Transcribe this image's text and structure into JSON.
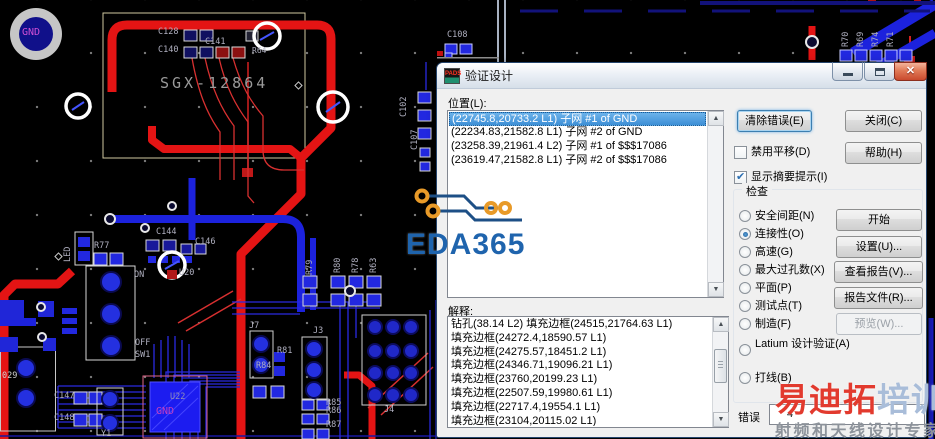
{
  "dialog": {
    "icon_text": "PADS",
    "title": "验证设计",
    "location_label": "位置(L):",
    "location_items": [
      "(22745.8,20733.2 L1) 子网 #1 of GND",
      "(22234.83,21582.8 L1) 子网 #2 of GND",
      "(23258.39,21961.4 L2) 子网 #1 of $$$17086",
      "(23619.47,21582.8 L1) 子网 #2 of $$$17086"
    ],
    "buttons": {
      "clear_errors": "清除错误(E)",
      "close": "关闭(C)",
      "help": "帮助(H)"
    },
    "checkboxes": {
      "disable_pan": "禁用平移(D)",
      "show_summary": "显示摘要提示(I)"
    },
    "check": {
      "label": "检查",
      "options": [
        "安全间距(N)",
        "连接性(O)",
        "高速(G)",
        "最大过孔数(X)",
        "平面(P)",
        "测试点(T)",
        "制造(F)",
        "Latium 设计验证(A)",
        "打线(B)"
      ],
      "selected": "连接性(O)"
    },
    "action_buttons": {
      "start": "开始",
      "setup": "设置(U)...",
      "view_report": "查看报告(V)...",
      "report_file": "报告文件(R)...",
      "preview": "预览(W)..."
    },
    "explain_label": "解释:",
    "explain_items": [
      "钻孔(38.14 L2) 填充边框(24515,21764.63 L1)",
      "填充边框(24272.4,18590.57 L1)",
      "填充边框(24275.57,18451.2 L1)",
      "填充边框(24346.71,19096.21 L1)",
      "填充边框(23760,20199.23 L1)",
      "填充边框(22507.59,19980.61 L1)",
      "填充边框(22717.4,19554.1 L1)",
      "填充边框(23104,20115.02 L1)"
    ],
    "error_label": "错误",
    "error_count": "4"
  },
  "watermarks": {
    "eda365": "EDA365",
    "brand_red": "易迪拓",
    "brand_blue": "培训",
    "brand_sub": "射频和天线设计专家"
  },
  "pcb": {
    "colors": {
      "trace_red": "#e41414",
      "trace_blue": "#1c22dd",
      "silkscreen": "#d6d6d6",
      "net_text": "#c23fc2"
    },
    "labels": [
      {
        "t": "GND",
        "x": 22,
        "y": 28,
        "c": "#cf4fd4",
        "s": 10
      },
      {
        "t": "C128",
        "x": 158,
        "y": 28
      },
      {
        "t": "C140",
        "x": 158,
        "y": 46
      },
      {
        "t": "C141",
        "x": 205,
        "y": 38
      },
      {
        "t": "SGX-12864",
        "x": 160,
        "y": 76,
        "s": 15,
        "c": "#9a9a9a",
        "ls": 3
      },
      {
        "t": "R64",
        "x": 252,
        "y": 47,
        "s": 8
      },
      {
        "t": "C108",
        "x": 447,
        "y": 31
      },
      {
        "t": "R70",
        "x": 842,
        "y": 47,
        "r": -90
      },
      {
        "t": "R69",
        "x": 857,
        "y": 47,
        "r": -90
      },
      {
        "t": "R74",
        "x": 872,
        "y": 47,
        "r": -90
      },
      {
        "t": "R71",
        "x": 887,
        "y": 47,
        "r": -90
      },
      {
        "t": "LED",
        "x": 64,
        "y": 262,
        "r": -90
      },
      {
        "t": "R77",
        "x": 94,
        "y": 242
      },
      {
        "t": "C144",
        "x": 156,
        "y": 228
      },
      {
        "t": "C146",
        "x": 195,
        "y": 238
      },
      {
        "t": "ON",
        "x": 134,
        "y": 271
      },
      {
        "t": "U20",
        "x": 179,
        "y": 269
      },
      {
        "t": "OFF",
        "x": 135,
        "y": 339
      },
      {
        "t": "SW1",
        "x": 135,
        "y": 351
      },
      {
        "t": "029",
        "x": 2,
        "y": 372,
        "c": "#cfcfcf"
      },
      {
        "t": "C147",
        "x": 54,
        "y": 392
      },
      {
        "t": "C148",
        "x": 54,
        "y": 414
      },
      {
        "t": "Y1",
        "x": 101,
        "y": 430
      },
      {
        "t": "U22",
        "x": 170,
        "y": 393,
        "c": "#8f8fb8"
      },
      {
        "t": "GND",
        "x": 156,
        "y": 407,
        "c": "#c23fc2",
        "s": 10
      },
      {
        "t": "J7",
        "x": 249,
        "y": 322
      },
      {
        "t": "J3",
        "x": 313,
        "y": 327
      },
      {
        "t": "J4",
        "x": 384,
        "y": 406
      },
      {
        "t": "R84",
        "x": 256,
        "y": 362
      },
      {
        "t": "R81",
        "x": 277,
        "y": 347
      },
      {
        "t": "R85",
        "x": 326,
        "y": 399
      },
      {
        "t": "R86",
        "x": 326,
        "y": 407
      },
      {
        "t": "R87",
        "x": 326,
        "y": 421
      },
      {
        "t": "R79",
        "x": 306,
        "y": 275,
        "r": -90
      },
      {
        "t": "R80",
        "x": 334,
        "y": 273,
        "r": -90
      },
      {
        "t": "R78",
        "x": 352,
        "y": 273,
        "r": -90
      },
      {
        "t": "R63",
        "x": 370,
        "y": 273,
        "r": -90
      },
      {
        "t": "C102",
        "x": 400,
        "y": 117,
        "r": -90
      },
      {
        "t": "C107",
        "x": 411,
        "y": 150,
        "r": -90
      }
    ]
  }
}
